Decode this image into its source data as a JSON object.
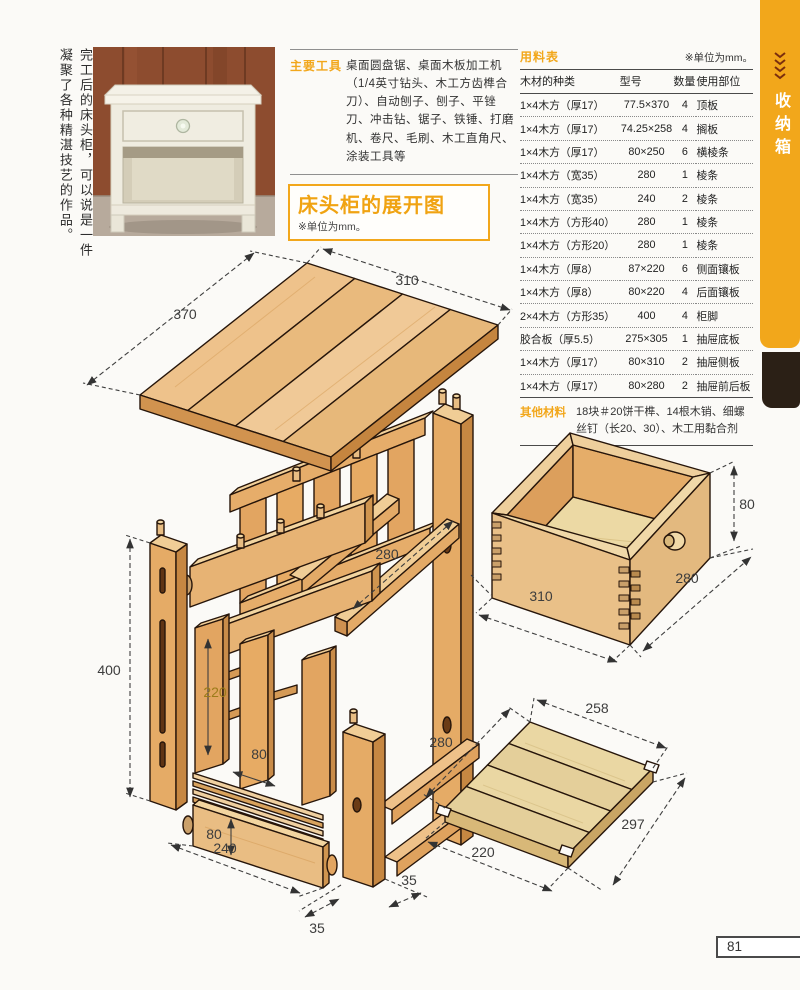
{
  "caption": {
    "text": "完工后的床头柜，可以说是一件凝聚了各种精湛技艺的作品。"
  },
  "tools": {
    "label": "主要工具",
    "text": "桌面圆盘锯、桌面木板加工机（1/4英寸钻头、木工方齿榫合刀）、自动刨子、刨子、平锉刀、冲击钻、锯子、铁锤、打磨机、卷尺、毛刷、木工直角尺、涂装工具等"
  },
  "title_box": {
    "title": "床头柜的展开图",
    "unit_note": "※单位为mm。"
  },
  "materials": {
    "label": "用料表",
    "unit_note": "※单位为mm。",
    "headers": [
      "木材的种类",
      "型号",
      "数量",
      "使用部位"
    ],
    "rows": [
      [
        "1×4木方（厚17）",
        "77.5×370",
        "4",
        "顶板"
      ],
      [
        "1×4木方（厚17）",
        "74.25×258",
        "4",
        "搁板"
      ],
      [
        "1×4木方（厚17）",
        "80×250",
        "6",
        "横棱条"
      ],
      [
        "1×4木方（宽35）",
        "280",
        "1",
        "棱条"
      ],
      [
        "1×4木方（宽35）",
        "240",
        "2",
        "棱条"
      ],
      [
        "1×4木方（方形40）",
        "280",
        "1",
        "棱条"
      ],
      [
        "1×4木方（方形20）",
        "280",
        "1",
        "棱条"
      ],
      [
        "1×4木方（厚8）",
        "87×220",
        "6",
        "侧面镶板"
      ],
      [
        "1×4木方（厚8）",
        "80×220",
        "4",
        "后面镶板"
      ],
      [
        "2×4木方（方形35）",
        "400",
        "4",
        "柜脚"
      ],
      [
        "胶合板（厚5.5）",
        "275×305",
        "1",
        "抽屉底板"
      ],
      [
        "1×4木方（厚17）",
        "80×310",
        "2",
        "抽屉侧板"
      ],
      [
        "1×4木方（厚17）",
        "80×280",
        "2",
        "抽屉前后板"
      ]
    ],
    "other_label": "其他材料",
    "other_text": "18块＃20饼干榫、14根木销、细螺丝钉（长20、30）、木工用黏合剂"
  },
  "sidebar_tab": {
    "label": "收纳箱"
  },
  "page_number": "81",
  "colors": {
    "accent": "#f2a71b",
    "tab_black": "#2b2016",
    "wood_face": "#e3aa67",
    "wood_top": "#f0cd96"
  },
  "diagram": {
    "dims": {
      "top_depth": "370",
      "top_width": "310",
      "rail_length": "280",
      "leg_height": "400",
      "side_panel_height": "220",
      "side_panel_width": "80",
      "stack_height": "80",
      "stack_length": "240",
      "leg_foot_left": "35",
      "leg_foot_right": "35",
      "drawer_height": "80",
      "drawer_depth": "280",
      "drawer_width": "310",
      "shelf_top_width": "258",
      "shelf_back_depth": "280",
      "shelf_front_depth": "297",
      "shelf_bottom_width": "220"
    }
  }
}
